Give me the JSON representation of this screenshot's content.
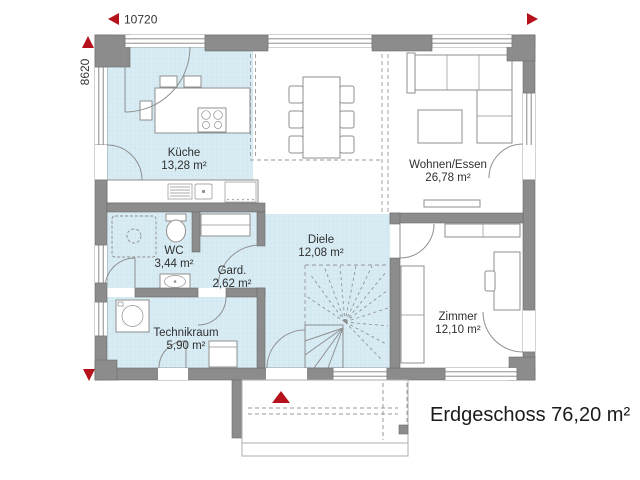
{
  "plan": {
    "footer_label": "Erdgeschoss 76,20 m²",
    "dimensions": {
      "width": "10720",
      "height": "8620"
    },
    "rooms": {
      "kueche": {
        "name": "Küche",
        "area": "13,28 m²"
      },
      "wohnen": {
        "name": "Wohnen/Essen",
        "area": "26,78 m²"
      },
      "wc": {
        "name": "WC",
        "area": "3,44 m²"
      },
      "garderobe": {
        "name": "Gard.",
        "area": "2,62 m²"
      },
      "diele": {
        "name": "Diele",
        "area": "12,08 m²"
      },
      "technikraum": {
        "name": "Technikraum",
        "area": "5,90 m²"
      },
      "zimmer": {
        "name": "Zimmer",
        "area": "12,10 m²"
      }
    },
    "colors": {
      "wall_gray": "#8c8c8c",
      "room_highlight_blue": "#d9ecf4",
      "accent_red": "#b5121b",
      "text": "#2f2f2f"
    }
  }
}
